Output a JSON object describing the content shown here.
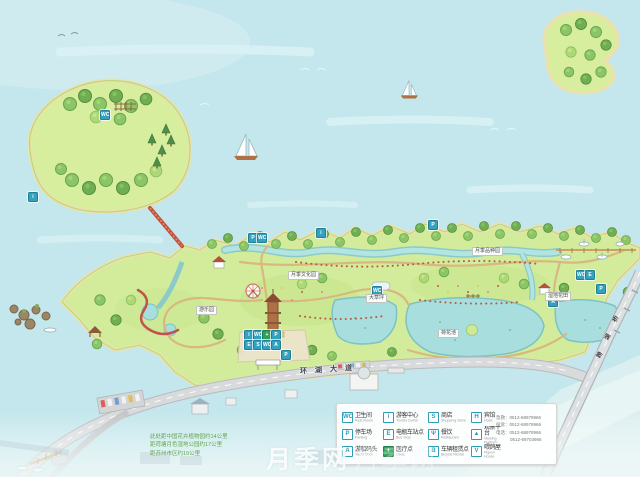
{
  "map": {
    "watermark": "月季网",
    "road_name": {
      "c0": "环",
      "c1": "湖",
      "c2": "大",
      "c3": "道"
    },
    "bridge_name": {
      "c0": "跨",
      "c1": "湖",
      "c2": "桥"
    },
    "area_labels": [
      {
        "text": "月季文化园"
      },
      {
        "text": "大草坪"
      },
      {
        "text": "月季品种园"
      },
      {
        "text": "荷花池"
      },
      {
        "text": "湿地花田"
      },
      {
        "text": "游乐园"
      }
    ],
    "distance_notes": [
      "此处距中国花卉植物园约14公里",
      "距荷塘月色湿地公园约17公里",
      "距苏州市区约19公里"
    ]
  },
  "icons": {
    "wc": "WC",
    "parking": "P",
    "info": "i",
    "clinic": "+",
    "shuttle": "E",
    "shop": "S",
    "dock": "A"
  },
  "legend": {
    "items": [
      {
        "glyph": "WC",
        "label": "卫生间",
        "en": "Rest Room"
      },
      {
        "glyph": "i",
        "label": "游客中心",
        "en": "Tourist Center"
      },
      {
        "glyph": "S",
        "label": "商店",
        "en": "Shopping Store"
      },
      {
        "glyph": "H",
        "label": "宾馆",
        "en": "Hotel"
      },
      {
        "glyph": "P",
        "label": "停车场",
        "en": "Parking"
      },
      {
        "glyph": "E",
        "label": "电瓶车站点",
        "en": "Bus Stop"
      },
      {
        "glyph": "Ψ",
        "label": "餐饮",
        "en": "Restaurant"
      },
      {
        "glyph": "▲",
        "label": "观景平台",
        "en": "Viewing Platform"
      },
      {
        "glyph": "A",
        "label": "游船码头",
        "en": "Yacht Dock"
      },
      {
        "glyph": "+",
        "label": "医疗点",
        "en": "Clinic"
      },
      {
        "glyph": "B",
        "label": "车辆租赁点",
        "en": "Bicycle Rental"
      },
      {
        "glyph": "V",
        "label": "喂鸽屋",
        "en": "Pigeon House"
      }
    ],
    "contacts": [
      "急救：0512-68978966",
      "投诉：0512-68978966",
      "电话：0512-68978966",
      "0512-69703966"
    ]
  }
}
